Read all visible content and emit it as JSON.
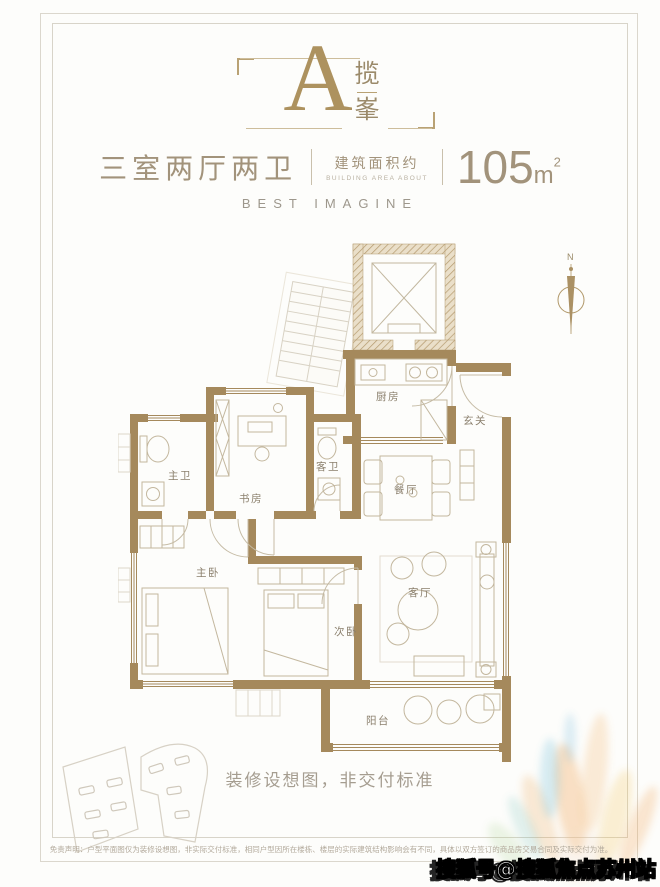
{
  "header": {
    "plan_letter": "A",
    "plan_name_top": "揽",
    "plan_name_bottom": "峯",
    "layout_title": "三室两厅两卫",
    "area_label_cn": "建筑面积约",
    "area_label_en": "BUILDING AREA ABOUT",
    "area_number": "105",
    "area_unit": "m",
    "area_exponent": "2",
    "tagline": "BEST IMAGINE"
  },
  "floorplan": {
    "compass": "N",
    "rooms": [
      {
        "id": "kitchen",
        "label": "厨房"
      },
      {
        "id": "foyer",
        "label": "玄关"
      },
      {
        "id": "master-bath",
        "label": "主卫"
      },
      {
        "id": "study",
        "label": "书房"
      },
      {
        "id": "guest-bath",
        "label": "客卫"
      },
      {
        "id": "dining",
        "label": "餐厅"
      },
      {
        "id": "master-bedroom",
        "label": "主卧"
      },
      {
        "id": "second-bedroom",
        "label": "次卧"
      },
      {
        "id": "living-room",
        "label": "客厅"
      },
      {
        "id": "balcony",
        "label": "阳台"
      }
    ]
  },
  "footer": {
    "render_note": "装修设想图，非交付标准",
    "disclaimer": "免责声明：户型平面图仅为装修设想图，非实际交付标准，相同户型因所在楼栋、楼层的实际建筑结构影响会有不同，具体以双方签订的商品房交易合同及实际交付为准。",
    "watermark": "搜狐号@搜狐焦点苏州站"
  },
  "colors": {
    "accent_gold": "#ad925f",
    "wall_tan": "#a5895c",
    "text_tan": "#a2937b",
    "text_gray": "#9d978c"
  }
}
